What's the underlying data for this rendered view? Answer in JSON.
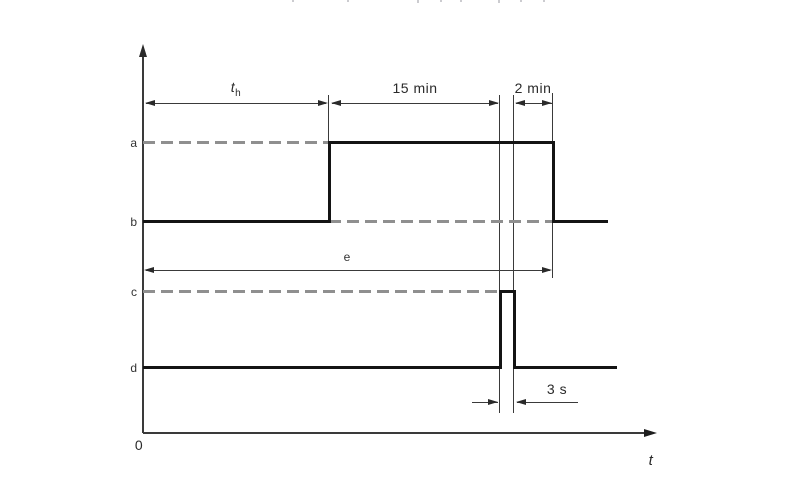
{
  "diagram": {
    "type": "timing-diagram",
    "colors": {
      "background": "#ffffff",
      "signal": "#141414",
      "dashed_reference": "#8f8f8f",
      "thin_lines": "#3a3a3a",
      "text": "#2a2a2a"
    },
    "axis": {
      "origin": "0",
      "time_label": "t"
    },
    "level_labels": {
      "a": "a",
      "b": "b",
      "c": "c",
      "d": "d"
    },
    "dimensions": {
      "heating": {
        "base": "t",
        "sub": "h"
      },
      "hold": "15 min",
      "post": "2 min",
      "pulse": "3 s",
      "total": "e"
    },
    "timing": {
      "signals": [
        {
          "name": "upper-signal",
          "low_level": "b",
          "high_level": "a",
          "description": "at level b from 0; rises to a after t_h; stays at a for 15 min, then (spanning the 3 s pulse marks) a further 2 min; returns to b"
        },
        {
          "name": "lower-signal",
          "low_level": "d",
          "high_level": "c",
          "description": "at level d from 0; single 3 s pulse to level c occurring 15 min after the upper signal rises; upper signal falls 2 min after the pulse"
        }
      ],
      "total_span": "e spans from 0 to the falling edge of the upper signal"
    }
  }
}
